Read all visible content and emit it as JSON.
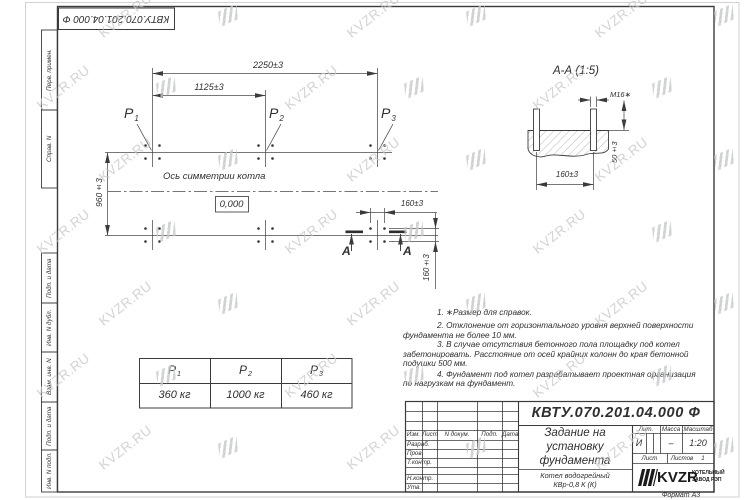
{
  "sheet": {
    "doc_number": "КВТУ.070.201.04.000  Ф",
    "format": "Формат А3",
    "frame_labels": [
      "Перв. примен.",
      "Справ. N",
      "Подп. и дата",
      "Инв. N дубл.",
      "Взам. инв. N",
      "Подп. и дата",
      "Инв. N подл."
    ]
  },
  "watermark": {
    "text": "KVZR.RU",
    "color": "#c6c9cb"
  },
  "plan": {
    "dim_width_total": "2250±3",
    "dim_width_half": "1125±3",
    "dim_depth": "960±3",
    "dim_bolt_h": "160±3",
    "dim_bolt_v": "160±3",
    "axis_label": "Ось симметрии котла",
    "elevation": "0,000",
    "points": [
      {
        "base": "P",
        "sub": "1"
      },
      {
        "base": "P",
        "sub": "2"
      },
      {
        "base": "P",
        "sub": "3"
      }
    ],
    "section_letter": "A"
  },
  "section": {
    "title": "А-А (1:5)",
    "thread": "М16∗",
    "dim_height": "50±3",
    "dim_spacing": "160±3"
  },
  "notes": {
    "lines": [
      "1. ∗Размер для справок.",
      "2. Отклонение от горизонтального уровня верхней поверхности",
      "фундамента не более 10 мм.",
      "3. В случае отсутствия бетонного пола площадку под котел",
      "забетонировать. Расстояние от осей крайних колонн до края бетонной",
      "подушки 500 мм.",
      "4. Фундамент под котел разрабатывает проектная организация",
      "по нагрузкам на фундамент."
    ]
  },
  "load_table": {
    "headers": [
      {
        "base": "P",
        "sub": "1"
      },
      {
        "base": "P",
        "sub": "2"
      },
      {
        "base": "P",
        "sub": "3"
      }
    ],
    "values": [
      "360  кг",
      "1000  кг",
      "460  кг"
    ]
  },
  "stamp": {
    "doc_number": "КВТУ.070.201.04.000  Ф",
    "header_cols": [
      "Изм.",
      "Лист",
      "N докум.",
      "Подп.",
      "Дата"
    ],
    "row_labels": [
      "Разраб.",
      "Пров.",
      "Т.контр.",
      "Н.контр.",
      "Утв."
    ],
    "title_lines": [
      "Задание на",
      "установку",
      "фундамента"
    ],
    "product_lines": [
      "Котел водогрейный",
      "КВр-0,8 К (К)"
    ],
    "lit_label": "Лит.",
    "mass_label": "Масса",
    "scale_label": "Масштаб",
    "lit_value": "И",
    "mass_value": "–",
    "scale_value": "1:20",
    "sheet_label": "Лист",
    "sheets_label": "Листов",
    "sheets_value": "1",
    "logo": {
      "name": "KVZR",
      "sub1": "КОТЕЛЬНЫЙ",
      "sub2": "ЗАВОД РЭП"
    }
  }
}
